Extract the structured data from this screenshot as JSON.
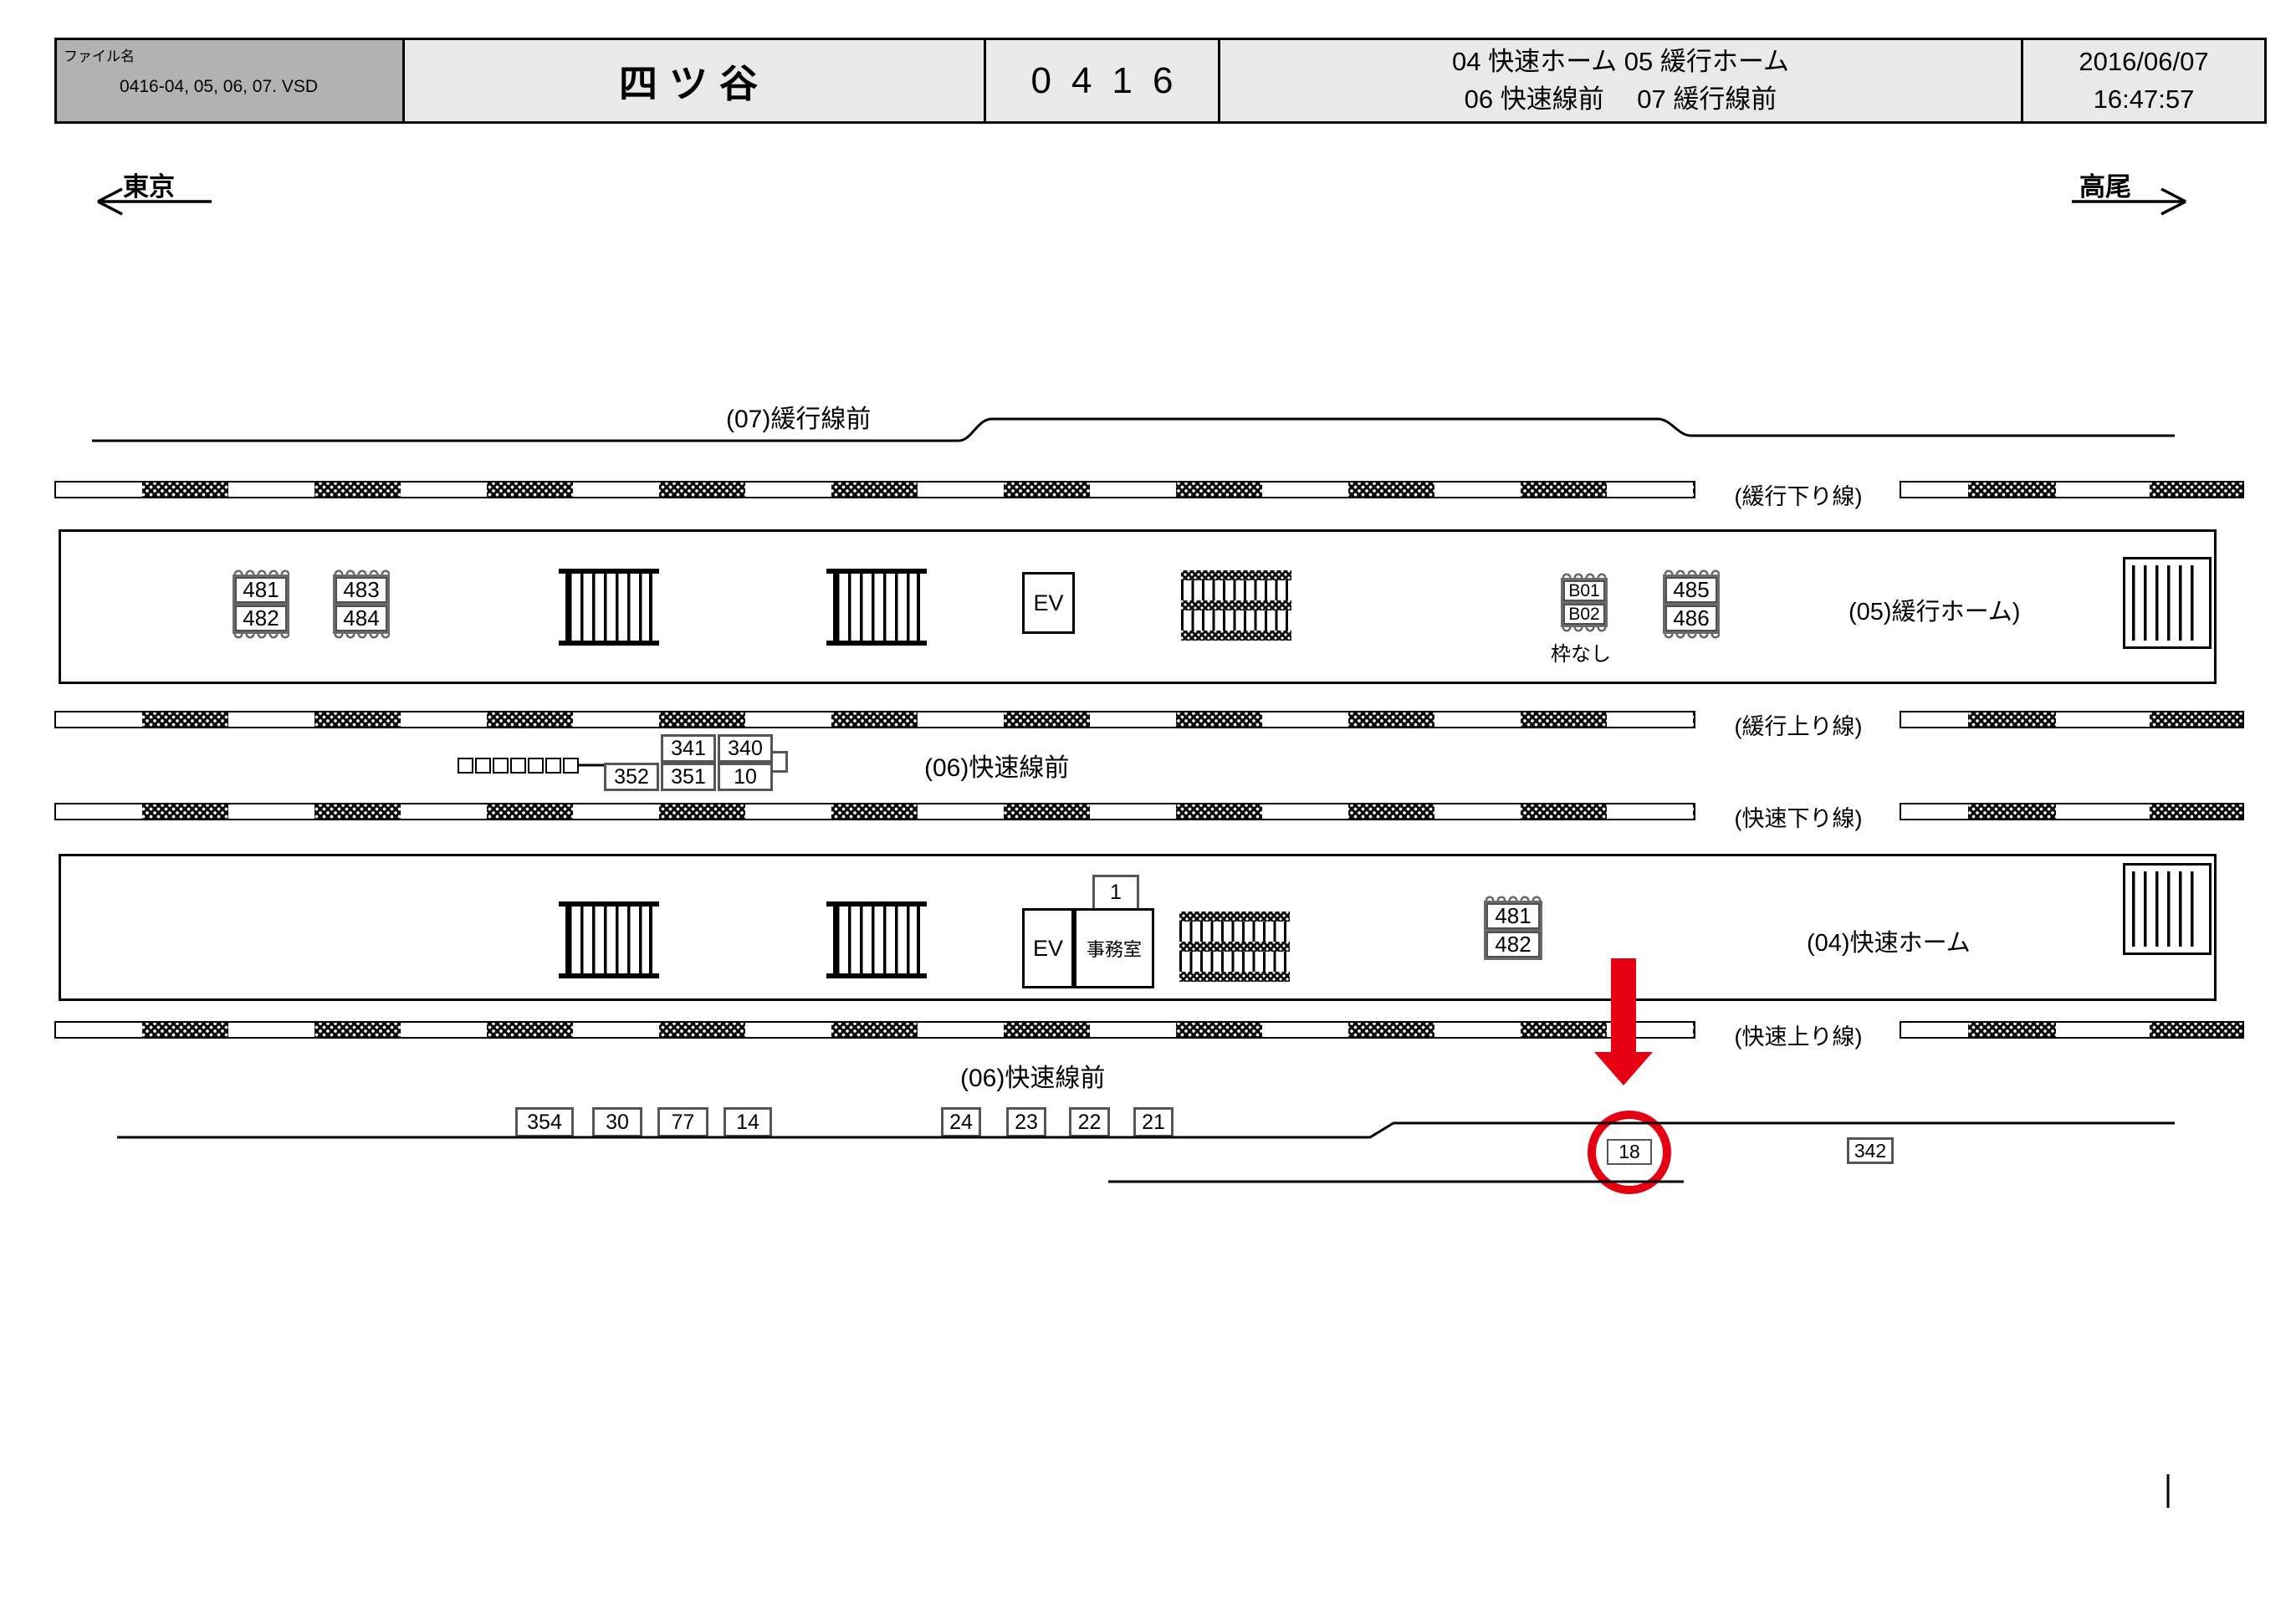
{
  "header": {
    "file_label": "ファイル名",
    "file_name": "0416-04, 05, 06, 07. VSD",
    "station": "四ツ谷",
    "code": "0416",
    "legend_line1": "04 快速ホーム  05 緩行ホーム",
    "legend_line2": "06 快速線前　 07 緩行線前",
    "date": "2016/06/07",
    "time": "16:47:57"
  },
  "directions": {
    "left": "東京",
    "right": "高尾"
  },
  "sections": {
    "top": "(07)緩行線前",
    "mid": "(06)快速線前",
    "bottom": "(06)快速線前"
  },
  "tracks": [
    {
      "label": "(緩行下り線)"
    },
    {
      "label": "(緩行上り線)"
    },
    {
      "label": "(快速下り線)"
    },
    {
      "label": "(快速上り線)"
    }
  ],
  "platforms": {
    "p05": "(05)緩行ホーム)",
    "p04": "(04)快速ホーム"
  },
  "facilities": {
    "ev": "EV",
    "office": "事務室",
    "one": "1"
  },
  "signs": {
    "s481u": {
      "top": "481",
      "bottom": "482"
    },
    "s483": {
      "top": "483",
      "bottom": "484"
    },
    "b01": {
      "top": "B01",
      "bottom": "B02",
      "note": "枠なし"
    },
    "s485": {
      "top": "485",
      "bottom": "486"
    },
    "s481l": {
      "top": "481",
      "bottom": "482"
    }
  },
  "cluster": {
    "c341": "341",
    "c340": "340",
    "c352": "352",
    "c351": "351",
    "c10": "10"
  },
  "boxes": {
    "bottom_left": [
      "354",
      "30",
      "77",
      "14"
    ],
    "bottom_right": [
      "24",
      "23",
      "22",
      "21"
    ],
    "s18": "18",
    "s342": "342"
  },
  "colors": {
    "annotation_red": "#e60012",
    "sign_frame_gray": "#6a6a6a",
    "header_gray": "#b2b2b2",
    "header_light": "#e9e9e9"
  }
}
